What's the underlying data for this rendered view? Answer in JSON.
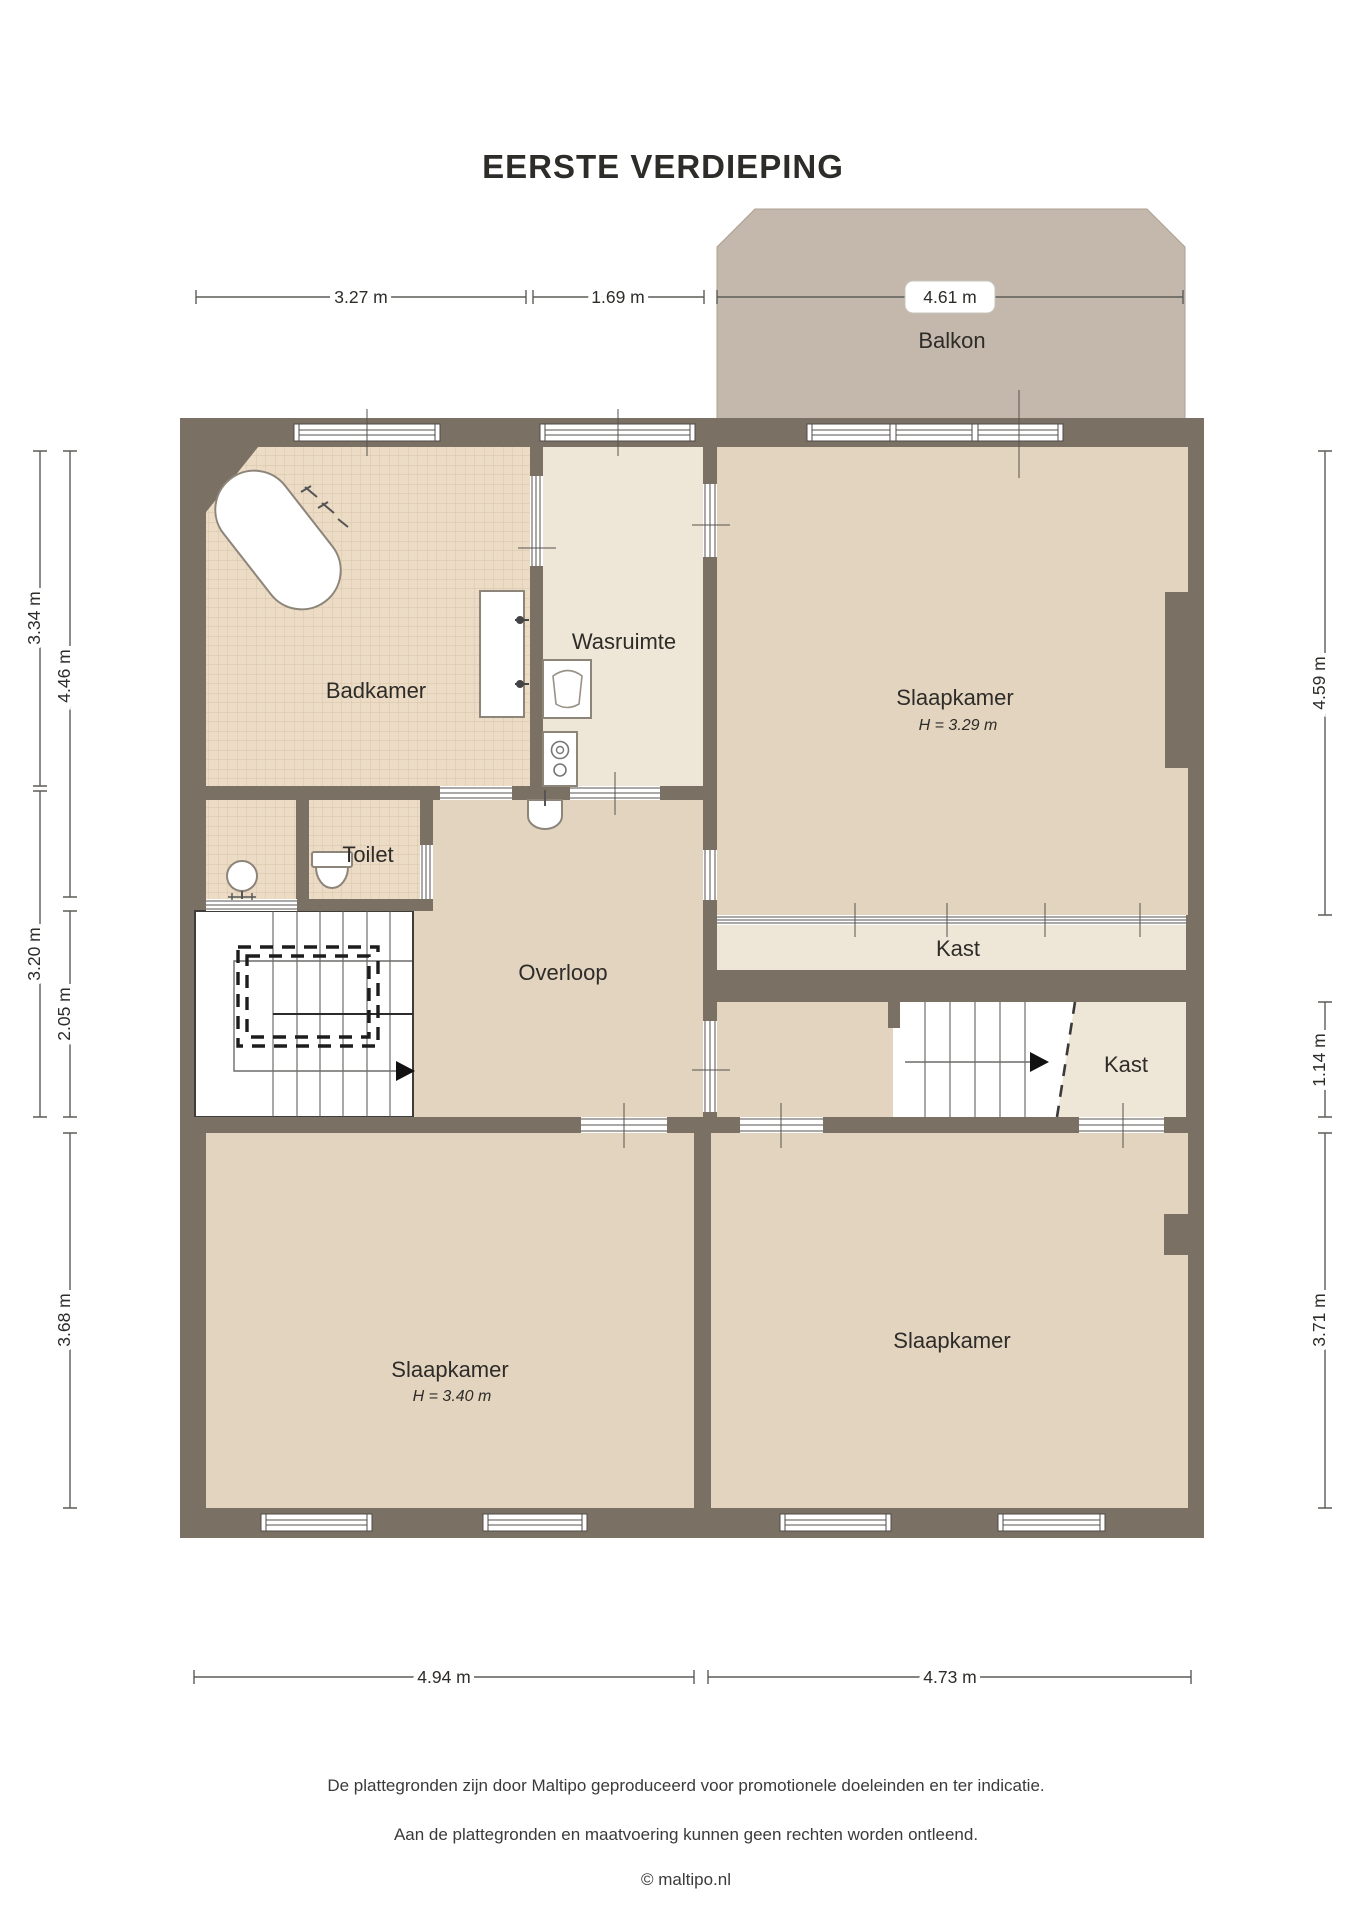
{
  "title": "EERSTE VERDIEPING",
  "rooms": {
    "balkon": {
      "label": "Balkon"
    },
    "badkamer": {
      "label": "Badkamer"
    },
    "wasruimte": {
      "label": "Wasruimte"
    },
    "slaapkamer_top": {
      "label": "Slaapkamer",
      "height": "H = 3.29 m"
    },
    "kast_top": {
      "label": "Kast"
    },
    "toilet": {
      "label": "Toilet"
    },
    "overloop": {
      "label": "Overloop"
    },
    "kast_mid": {
      "label": "Kast"
    },
    "slaapkamer_left": {
      "label": "Slaapkamer",
      "height": "H = 3.40 m"
    },
    "slaapkamer_right": {
      "label": "Slaapkamer"
    }
  },
  "dimensions": {
    "top": [
      "3.27 m",
      "1.69 m",
      "4.61 m"
    ],
    "left_outer": [
      "3.34 m",
      "3.20 m"
    ],
    "left_inner": [
      "4.46 m",
      "2.05 m",
      "3.68 m"
    ],
    "right": [
      "4.59 m",
      "1.14 m",
      "3.71 m"
    ],
    "bottom": [
      "4.94 m",
      "4.73 m"
    ]
  },
  "footer": {
    "line1": "De plattegronden zijn door Maltipo geproduceerd voor promotionele doeleinden en ter indicatie.",
    "line2": "Aan de plattegronden en maatvoering kunnen geen rechten worden ontleend.",
    "line3": "© maltipo.nl"
  },
  "colors": {
    "wall": "#7a7064",
    "balcony": "#c3b8ab",
    "floor_tan": "#e3d4bf",
    "floor_cream": "#eee6d6",
    "tile": "#ecdbc5",
    "tile_grid": "#d9c3aa"
  }
}
